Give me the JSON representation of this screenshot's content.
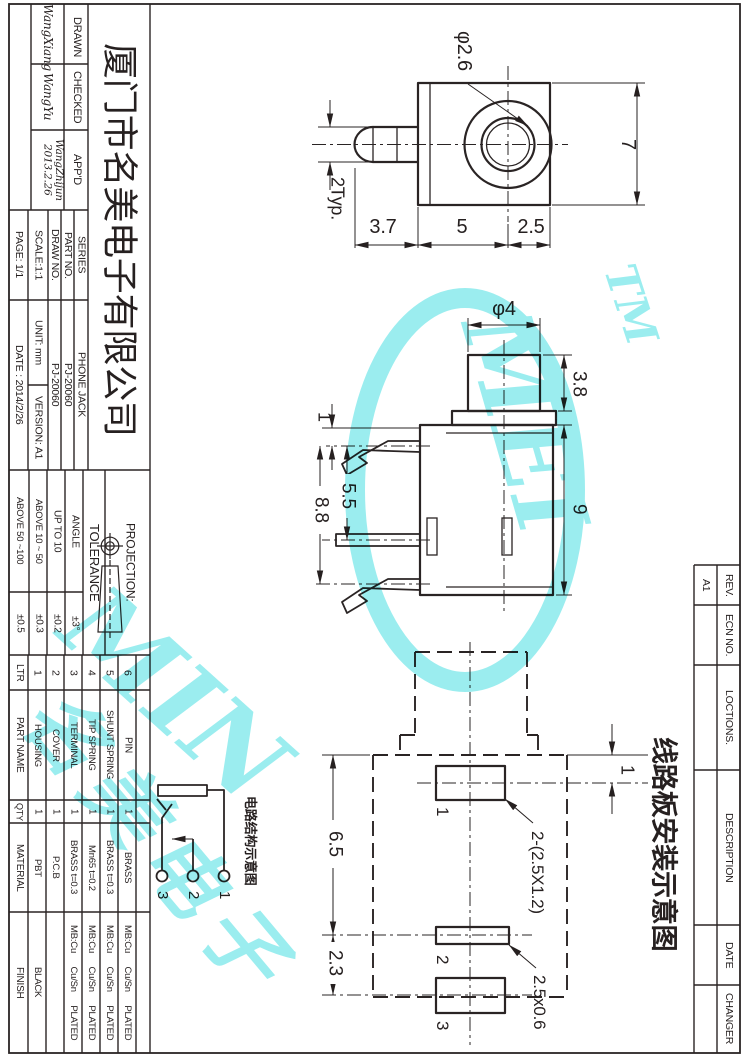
{
  "title_block": {
    "company": "厦门市名美电子有限公司",
    "drawn_label": "DRAWN",
    "drawn_sign": "WangXiang",
    "checked_label": "CHECKED",
    "checked_sign": "WangYu",
    "appd_label": "APP'D",
    "appd_sign": "WangZhijun",
    "appd_sign_date": "2013.2.26",
    "series_label": "SERIES",
    "series_value": "PHONE JACK",
    "part_no_label": "PART  NO.",
    "part_no_value": "PJ-20060",
    "draw_no_label": "DRAW NO.",
    "draw_no_value": "PJ-20060",
    "scale": "SCALE:1:1",
    "unit": "UNIT: mm",
    "version": "VERSION: A1",
    "page": "PAGE:  1/1",
    "date": "DATE : 2014/2/26"
  },
  "projection": {
    "label": "PROJECTION:"
  },
  "tolerance": {
    "header": "TOLERANCE",
    "rows": [
      {
        "label": "ANGLE",
        "value": "±3°"
      },
      {
        "label": "UP TO 10",
        "value": "±0.2"
      },
      {
        "label": "ABOVE 10 ~ 50",
        "value": "±0.3"
      },
      {
        "label": "ABOVE 50 ~100",
        "value": "±0.5"
      }
    ]
  },
  "parts_table": {
    "headers": {
      "ltr": "LTR",
      "part_name": "PART NAME",
      "qty": "QTY",
      "material": "MATERIAL",
      "finish": "FINISH"
    },
    "rows": [
      {
        "ltr": "6",
        "part_name": "PIN",
        "qty": "1",
        "material": "BRASS",
        "finish": "MB:Cu Cu/Sn PLATED"
      },
      {
        "ltr": "5",
        "part_name": "SHUNT SPRING",
        "qty": "1",
        "material": "BRASS t=0.3",
        "finish": "MB:Cu Cu/Sn PLATED"
      },
      {
        "ltr": "4",
        "part_name": "TIP SPRING",
        "qty": "1",
        "material": "Mn65 t=0.2",
        "finish": "MB:Cu Cu/Sn PLATED"
      },
      {
        "ltr": "3",
        "part_name": "TERMINAL",
        "qty": "1",
        "material": "BRASS t=0.3",
        "finish": "MB:Cu Cu/Sn PLATED"
      },
      {
        "ltr": "2",
        "part_name": "COVER",
        "qty": "1",
        "material": "P.C.B",
        "finish": ""
      },
      {
        "ltr": "1",
        "part_name": "HOUSING",
        "qty": "1",
        "material": "PBT",
        "finish": "BLACK"
      }
    ]
  },
  "revision_table": {
    "rev_label": "REV.",
    "rev_value": "A1",
    "ecn_label": "ECN NO.",
    "locations_label": "LOCTIONS.",
    "description_label": "DESCRIPTION",
    "date_label": "DATE",
    "changer_label": "CHANGER"
  },
  "views": {
    "top_view": {
      "dims": {
        "hole_dia": "φ2.6",
        "height": "7",
        "pin": "2Typ.",
        "d1": "3.7",
        "d2": "5",
        "d3": "2.5"
      }
    },
    "side_view": {
      "dims": {
        "bushing_dia": "φ4",
        "bushing_h": "3.8",
        "body_h": "9",
        "lead1": "1",
        "lead2": "5.5",
        "lead3": "8.8"
      }
    },
    "pcb_view": {
      "title": "线路板安装示意图",
      "dims": {
        "pad1_offset": "1",
        "d65": "6.5",
        "d23": "2.3",
        "slots": "2-(2.5X1.2)",
        "pad2": "2.5x0.6"
      },
      "pad_labels": {
        "p1": "1",
        "p2": "2",
        "p3": "3"
      }
    }
  },
  "circuit": {
    "title": "电路结构示意图",
    "t1": "1",
    "t2": "2",
    "t3": "3"
  },
  "watermark": {
    "tm": "TM",
    "min": "MIN",
    "mei": "MEI",
    "cn": "名美电子",
    "color": "#38dcdf"
  }
}
